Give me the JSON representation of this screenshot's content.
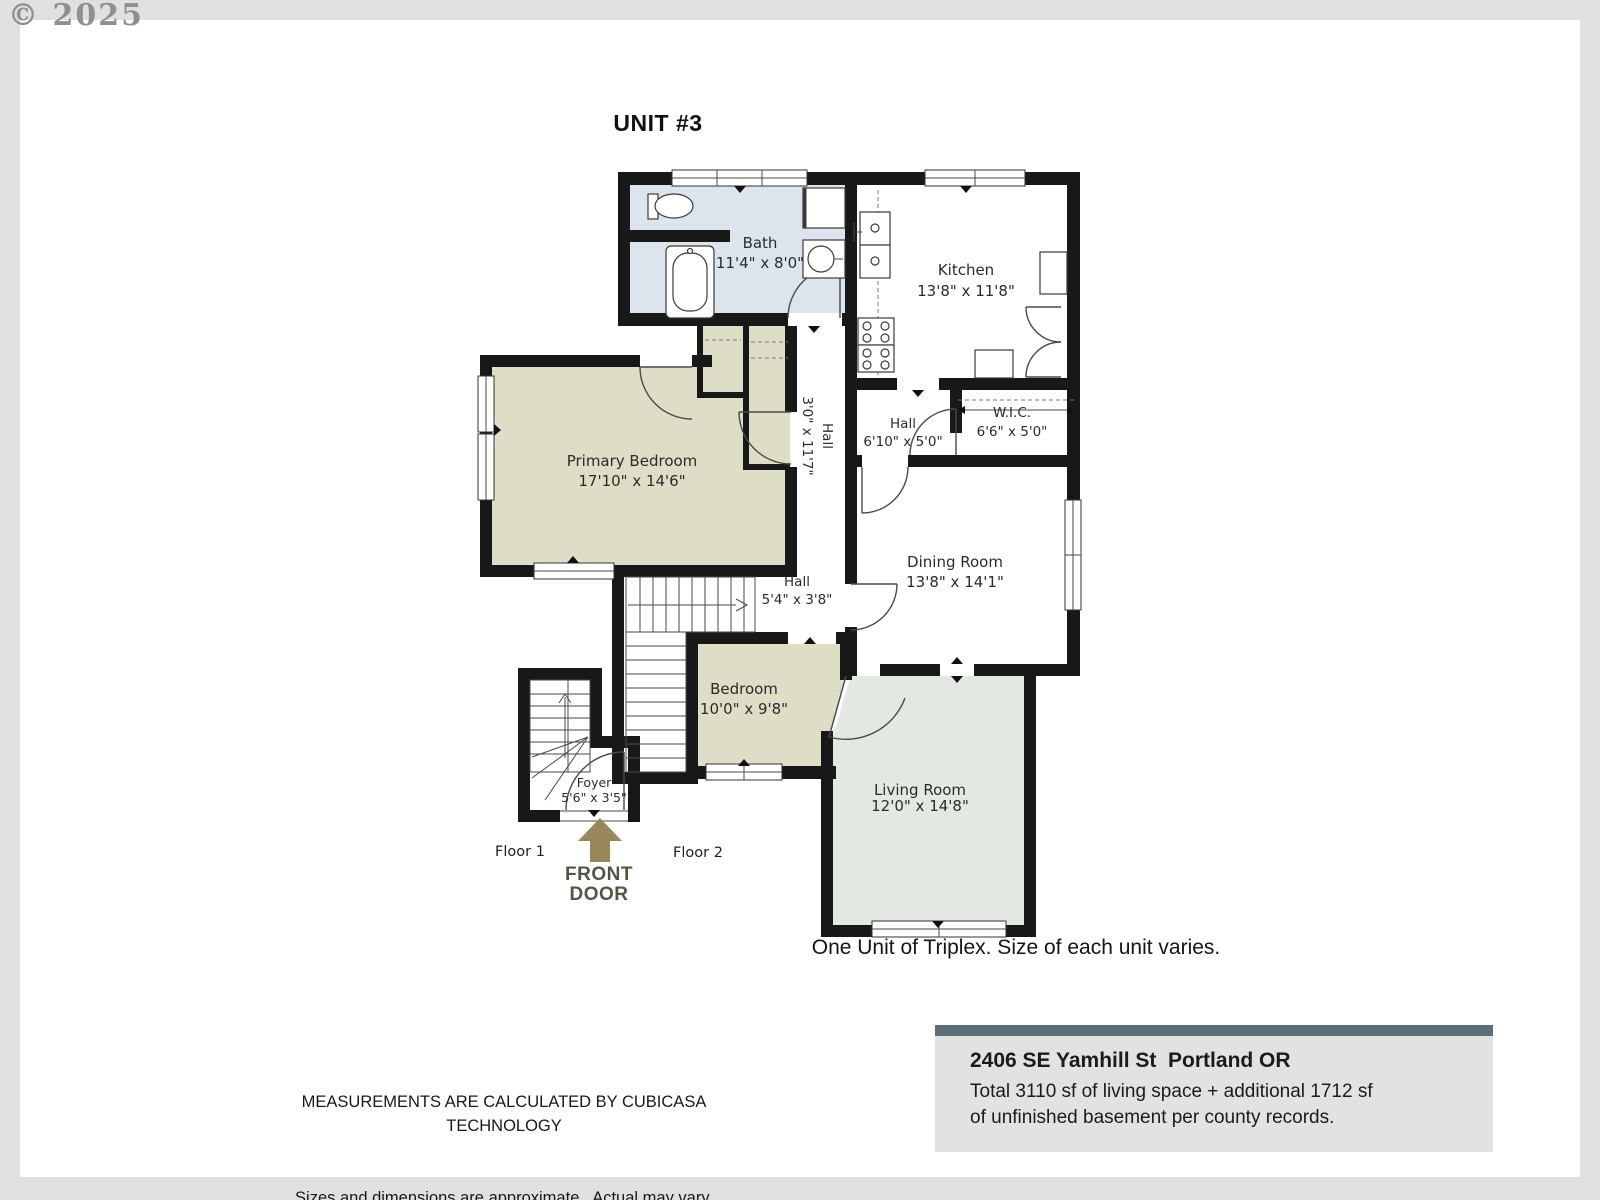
{
  "watermark": "© 2025",
  "title": "UNIT #3",
  "rooms": {
    "bath": {
      "name": "Bath",
      "dims": "11'4\" x 8'0\""
    },
    "kitchen": {
      "name": "Kitchen",
      "dims": "13'8\" x 11'8\""
    },
    "primary_bedroom": {
      "name": "Primary Bedroom",
      "dims": "17'10\" x 14'6\""
    },
    "hall_corridor": {
      "name": "Hall",
      "dims": "3'0\" x 11'7\""
    },
    "hall_upper": {
      "name": "Hall",
      "dims": "6'10\" x 5'0\""
    },
    "wic": {
      "name": "W.I.C.",
      "dims": "6'6\" x 5'0\""
    },
    "dining_room": {
      "name": "Dining Room",
      "dims": "13'8\" x 14'1\""
    },
    "hall_lower": {
      "name": "Hall",
      "dims": "5'4\" x 3'8\""
    },
    "bedroom": {
      "name": "Bedroom",
      "dims": "10'0\" x 9'8\""
    },
    "living_room": {
      "name": "Living Room",
      "dims": "12'0\" x 14'8\""
    },
    "foyer": {
      "name": "Foyer",
      "dims": "5'6\" x 3'5\""
    }
  },
  "floor_labels": {
    "floor1": "Floor 1",
    "floor2": "Floor 2"
  },
  "front_door": {
    "line1": "FRONT",
    "line2": "DOOR"
  },
  "caption": "One Unit of Triplex. Size of each unit varies.",
  "disclaimer": {
    "line1": "MEASUREMENTS ARE CALCULATED BY CUBICASA TECHNOLOGY",
    "line2": "Sizes and dimensions are approximate.  Actual may vary."
  },
  "address_card": {
    "address": "2406 SE Yamhill St  Portland OR",
    "detail1": "Total 3110 sf of living space + additional 1712 sf",
    "detail2": "of unfinished basement per county records."
  },
  "colors": {
    "wall": "#181818",
    "frame": "#e0e0e0",
    "bath_fill": "#dce5ee",
    "bedroom_fill": "#deddc6",
    "living_fill": "#e3e9e2",
    "accent_bar": "#5c6f77",
    "front_door_arrow": "#97875b"
  }
}
